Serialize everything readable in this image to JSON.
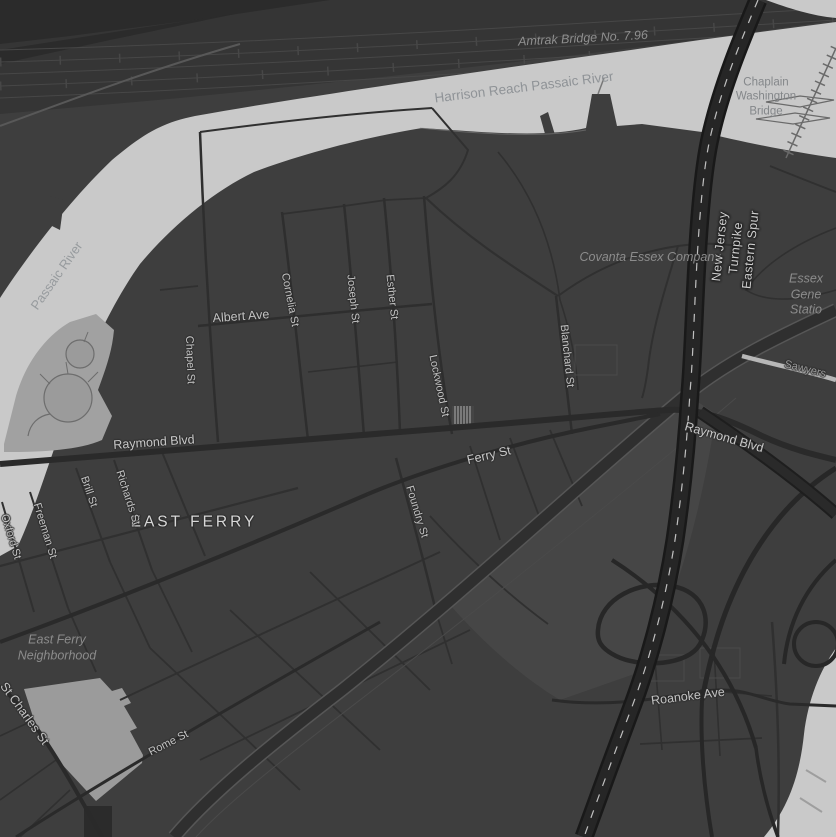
{
  "map": {
    "colors": {
      "land": "#3e3e3e",
      "water": "#c9c9c9",
      "rail_corridor": "#353535",
      "road_major": "#2a2a2a",
      "road_minor": "#303030",
      "highway": "#262626",
      "highway_casing": "#191919",
      "lane_dash": "#dcdcdc",
      "tank_farm": "#a1a1a1",
      "open_lot": "#9b9b9b",
      "street_label": "#c3c3c3",
      "water_label": "#8f9397",
      "area_label": "#8c8c8c",
      "highway_label": "#cfcfcf"
    },
    "labels": {
      "amtrak_bridge": "Amtrak Bridge No. 7.96",
      "harrison_reach": "Harrison Reach Passaic River",
      "chaplain_bridge": "Chaplain\nWashington\nBridge",
      "passaic_river": "Passaic River",
      "covanta": "Covanta Essex Company",
      "essex_station": "Essex Gene\nStatio",
      "nj_turnpike": "New Jersey Turnpike Eastern Spur",
      "blanchard": "Blanchard St",
      "lockwood": "Lockwood St",
      "esther": "Esther St",
      "joseph": "Joseph St",
      "cornelia": "Cornelia St",
      "albert": "Albert Ave",
      "chapel": "Chapel St",
      "raymond_w": "Raymond Blvd",
      "raymond_e": "Raymond Blvd",
      "ferry": "Ferry St",
      "foundry": "Foundry St",
      "east_ferry": "EAST FERRY",
      "brill": "Brill St",
      "richards": "Richards St",
      "freeman": "Freeman St",
      "oxford": "Oxford St",
      "east_ferry_neighborhood": "East Ferry\nNeighborhood",
      "st_charles": "St Charles St",
      "rome": "Rome St",
      "roanoke": "Roanoke Ave",
      "sawyers": "Sawyers"
    }
  }
}
